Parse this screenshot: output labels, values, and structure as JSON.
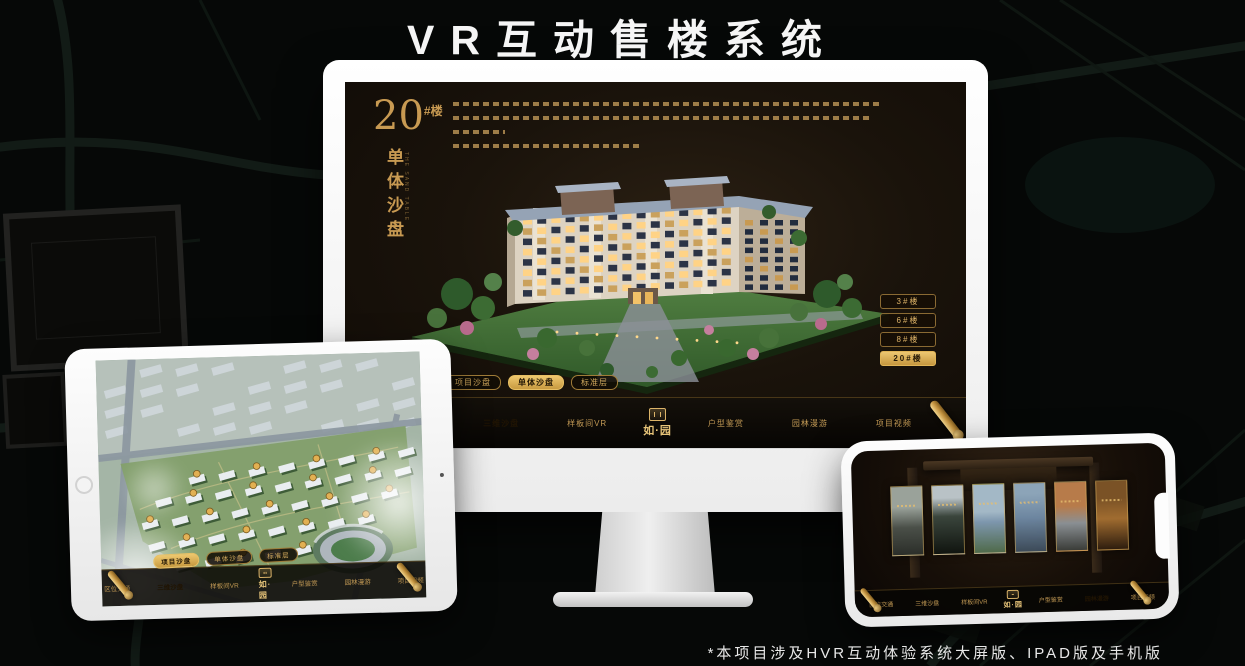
{
  "title": "VR互动售楼系统",
  "footnote": "*本项目涉及HVR互动体验系统大屏版、IPAD版及手机版",
  "colors": {
    "gold": "#c9a05c",
    "gold_bright": "#e7c578",
    "active_text": "#241806",
    "screen_bg": "#171007",
    "title_text": "#f5f5f5"
  },
  "desktop": {
    "headline": {
      "number": "20",
      "suffix": "#楼",
      "vertical": "单体沙盘",
      "caption": "THE SAND TABLE"
    },
    "sub_tabs": [
      {
        "label": "项目沙盘",
        "active": false
      },
      {
        "label": "单体沙盘",
        "active": true
      },
      {
        "label": "标准层",
        "active": false
      }
    ],
    "building_buttons": [
      {
        "label": "3#楼",
        "active": false
      },
      {
        "label": "6#楼",
        "active": false
      },
      {
        "label": "8#楼",
        "active": false
      },
      {
        "label": "20#楼",
        "active": true
      }
    ],
    "nav": {
      "logo": "如·园",
      "items": [
        {
          "label": "区位交通",
          "active": false
        },
        {
          "label": "三维沙盘",
          "active": true
        },
        {
          "label": "样板间VR",
          "active": false
        },
        {
          "label": "户型鉴赏",
          "active": false
        },
        {
          "label": "园林漫游",
          "active": false
        },
        {
          "label": "项目视频",
          "active": false
        }
      ]
    }
  },
  "tablet": {
    "sub_tabs": [
      {
        "label": "项目沙盘",
        "active": true
      },
      {
        "label": "单体沙盘",
        "active": false
      },
      {
        "label": "标准层",
        "active": false
      }
    ],
    "nav": {
      "logo": "如·园",
      "items": [
        {
          "label": "区位交通",
          "active": false
        },
        {
          "label": "三维沙盘",
          "active": true
        },
        {
          "label": "样板间VR",
          "active": false
        },
        {
          "label": "户型鉴赏",
          "active": false
        },
        {
          "label": "园林漫游",
          "active": false
        },
        {
          "label": "项目视频",
          "active": false
        }
      ]
    }
  },
  "phone": {
    "nav": {
      "logo": "如·园",
      "items": [
        {
          "label": "区位交通",
          "active": false
        },
        {
          "label": "三维沙盘",
          "active": false
        },
        {
          "label": "样板间VR",
          "active": false
        },
        {
          "label": "户型鉴赏",
          "active": false
        },
        {
          "label": "园林漫游",
          "active": true
        },
        {
          "label": "项目视频",
          "active": false
        }
      ]
    }
  }
}
